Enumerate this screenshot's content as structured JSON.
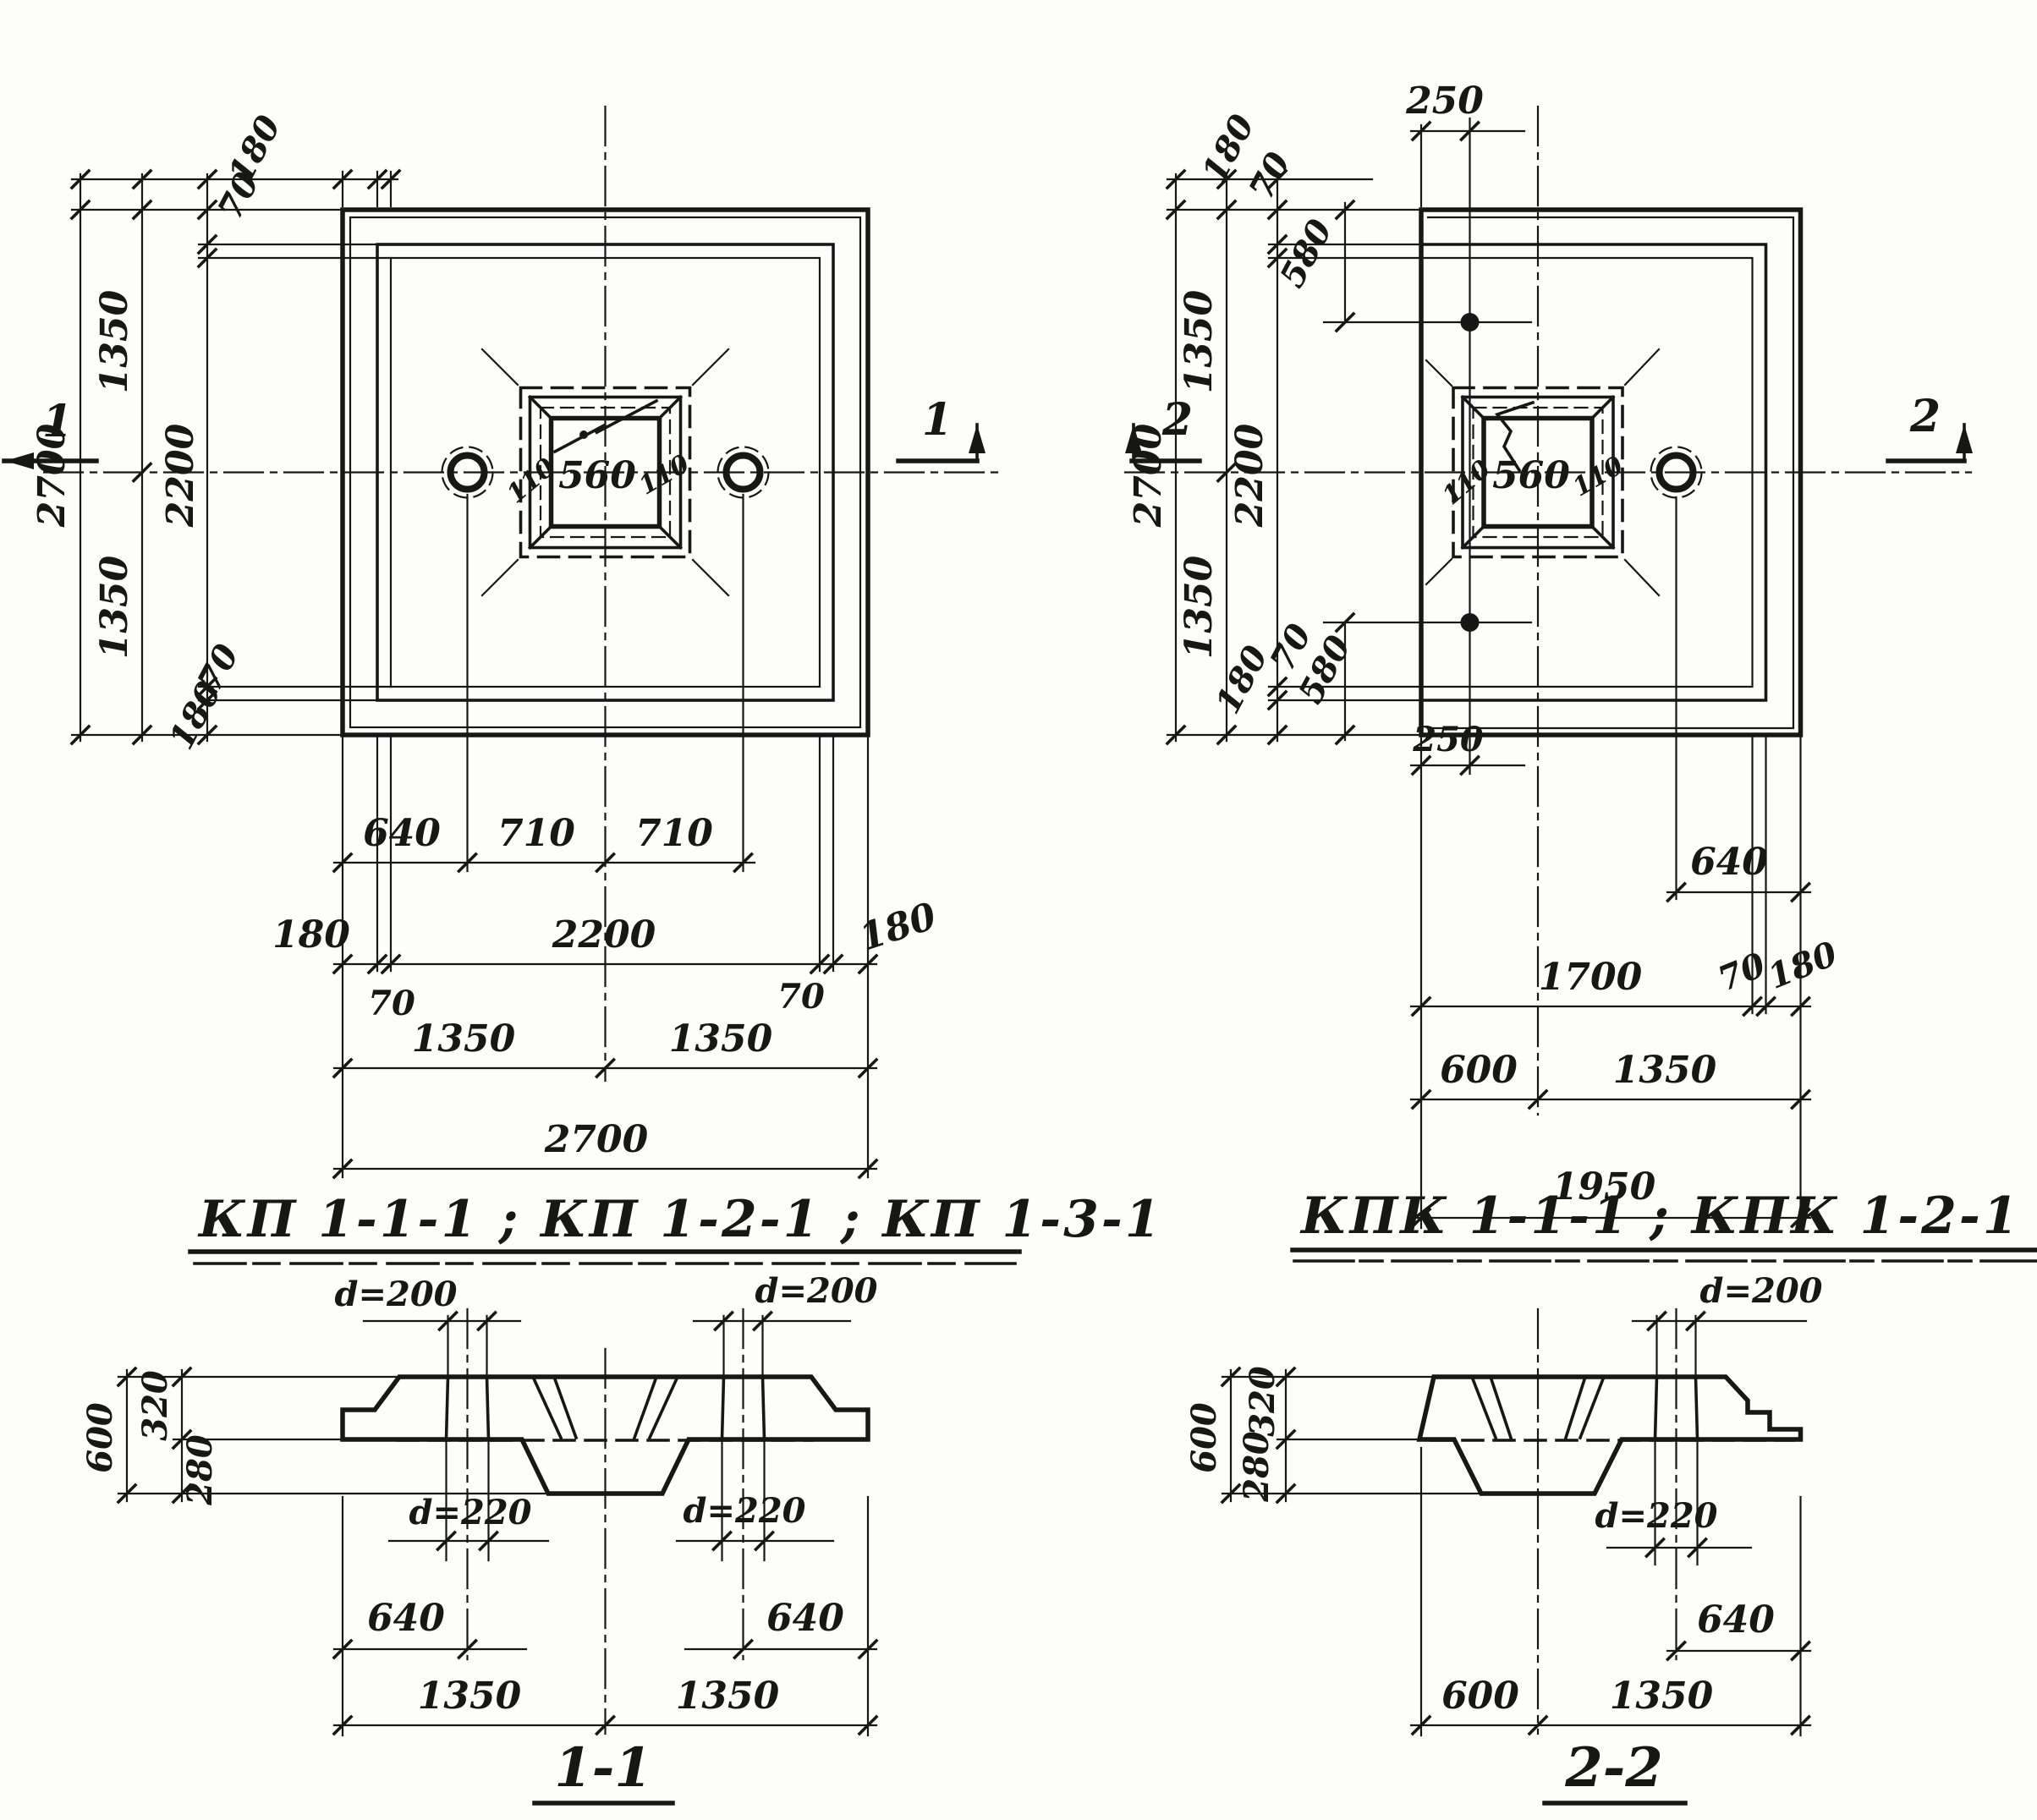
{
  "sheet": {
    "background": "#fdfdfb",
    "ink": "#181716"
  },
  "plan_kp": {
    "section_cut": "1",
    "socket": {
      "bevel_left": "110",
      "side": "560",
      "bevel_right": "110"
    },
    "left_chain": {
      "total": "2700",
      "half_top": "1350",
      "half_bottom": "1350",
      "inner": "2200",
      "edge_top": "180",
      "bevel_top": "70",
      "bevel_bottom": "70",
      "edge_bottom": "180"
    },
    "bottom_chain": {
      "hole_offset": "640",
      "hole_to_center": "710",
      "center_to_hole": "710",
      "edge_left": "180",
      "bevel_left": "70",
      "inner": "2200",
      "bevel_right": "70",
      "edge_right": "180",
      "half_left": "1350",
      "half_right": "1350",
      "total": "2700"
    }
  },
  "plan_kpk": {
    "section_cut": "2",
    "socket": {
      "bevel_left": "110",
      "side": "560",
      "bevel_right": "110"
    },
    "top_chain": {
      "hole_offset": "250"
    },
    "left_chain": {
      "total": "2700",
      "half_top": "1350",
      "half_bottom": "1350",
      "inner": "2200",
      "edge_top": "180",
      "bevel_top": "70",
      "hole_from_top": "580",
      "bevel_bottom": "70",
      "edge_bottom": "180",
      "hole_from_bottom": "580"
    },
    "bottom_chain": {
      "hole_offset": "250",
      "lug_offset": "640",
      "inner": "1700",
      "bevel": "70",
      "edge": "180",
      "cut_width": "600",
      "half": "1350",
      "total": "1950"
    }
  },
  "titles": {
    "kp": "КП 1-1-1 ; КП 1-2-1 ; КП 1-3-1",
    "kpk": "КПК 1-1-1 ; КПК 1-2-1 ; КПК 1-3-1"
  },
  "section_1_1": {
    "label": "1-1",
    "hole_dia_top": "d=200",
    "hole_dia_bottom": "d=220",
    "height_total": "600",
    "height_slab": "320",
    "height_boss": "280",
    "hole_offset": "640",
    "half_left": "1350",
    "half_right": "1350"
  },
  "section_2_2": {
    "label": "2-2",
    "hole_dia_top": "d=200",
    "hole_dia_bottom": "d=220",
    "height_total": "600",
    "height_slab": "320",
    "height_boss": "280",
    "hole_offset": "640",
    "cut_width": "600",
    "half": "1350"
  }
}
